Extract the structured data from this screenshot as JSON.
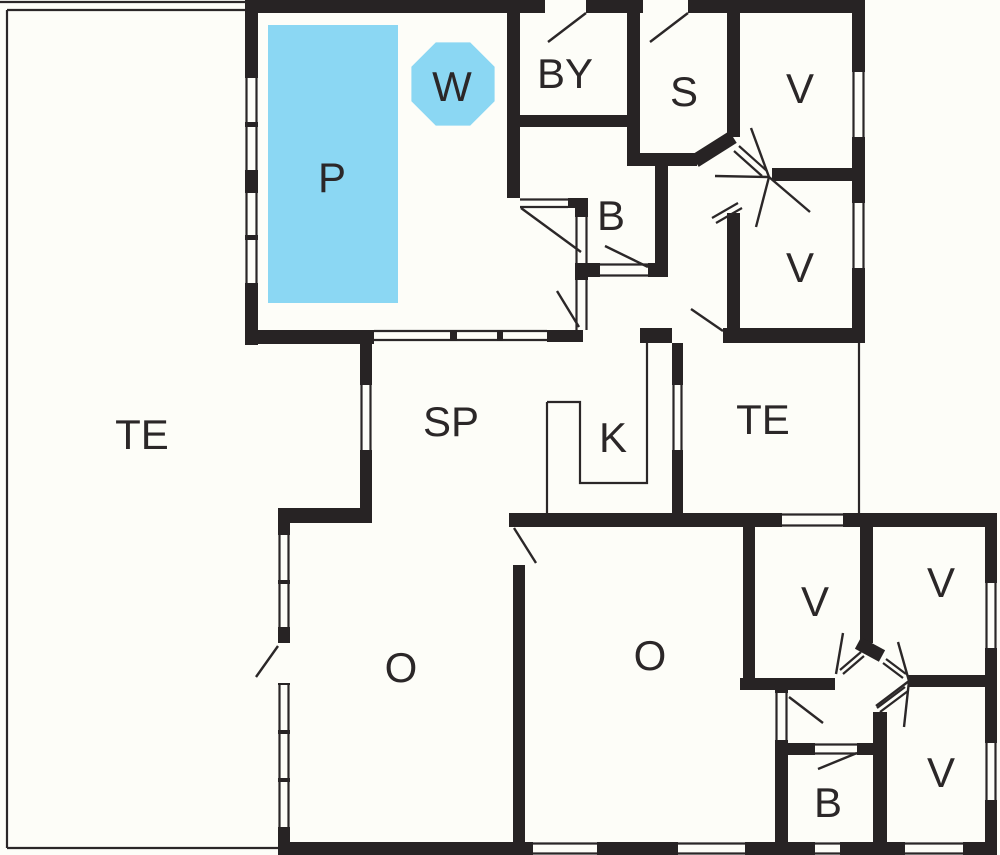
{
  "colors": {
    "wall": "#272324",
    "line": "#2b2728",
    "pool": "#8bd7f3",
    "bg": "#fdfdf8",
    "text": "#2b2728"
  },
  "rooms": [
    {
      "id": "terrace-left",
      "label": "TE"
    },
    {
      "id": "pool",
      "label": "P"
    },
    {
      "id": "whirlpool",
      "label": "W"
    },
    {
      "id": "utility",
      "label": "BY"
    },
    {
      "id": "sauna",
      "label": "S"
    },
    {
      "id": "bedroom-top-1",
      "label": "V"
    },
    {
      "id": "bedroom-top-2",
      "label": "V"
    },
    {
      "id": "bath-middle",
      "label": "B"
    },
    {
      "id": "dining",
      "label": "SP"
    },
    {
      "id": "kitchen",
      "label": "K"
    },
    {
      "id": "terrace-right",
      "label": "TE"
    },
    {
      "id": "living-left",
      "label": "O"
    },
    {
      "id": "living-middle",
      "label": "O"
    },
    {
      "id": "bedroom-annex-1",
      "label": "V"
    },
    {
      "id": "bedroom-annex-2",
      "label": "V"
    },
    {
      "id": "bedroom-annex-3",
      "label": "V"
    },
    {
      "id": "bath-annex",
      "label": "B"
    }
  ]
}
